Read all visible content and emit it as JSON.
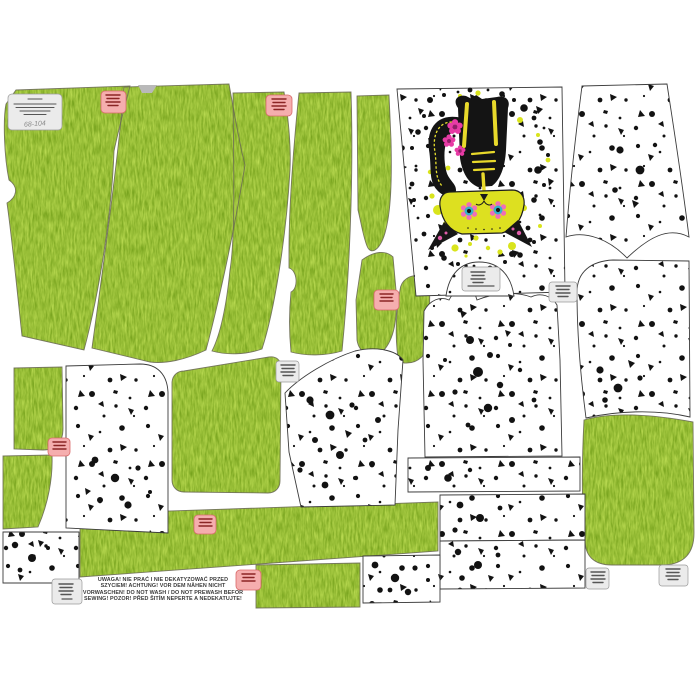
{
  "colors": {
    "background": "#ffffff",
    "fabric_green": "#95bf39",
    "fabric_green_light": "#bcdc7c",
    "fabric_green_dark": "#5f8f22",
    "splatter_black": "#121212",
    "splatter_yellow": "#d9e41c",
    "cat_body_black": "#141414",
    "cat_head_yellow": "#dde020",
    "cat_flower_pink": "#e73ba5",
    "cat_eye_teal": "#35b3c9",
    "cat_bone_yellow": "#e8d92b",
    "label_grey_bg": "#ebebeb",
    "label_grey_border": "#9a9a9a",
    "label_pink_bg": "#f5aeae",
    "label_pink_border": "#d96a6a",
    "piece_outline": "#3c3c3c"
  },
  "size_label": {
    "size_range": "68-104"
  },
  "care_warning": {
    "line1": "UWAGA! NIE PRAĆ I NIE DEKATYZOWAĆ PRZED",
    "line2": "SZYCIEM! ACHTUNG! VOR DEM NÄHEN NICHT",
    "line3": "VORWASCHEN! DO NOT WASH / DO NOT PREWASH  BEFOR",
    "line4": "SEWING! POZOR! PŘED ŠITÍM NEPERTE A  NEDEKATUJTE!"
  }
}
